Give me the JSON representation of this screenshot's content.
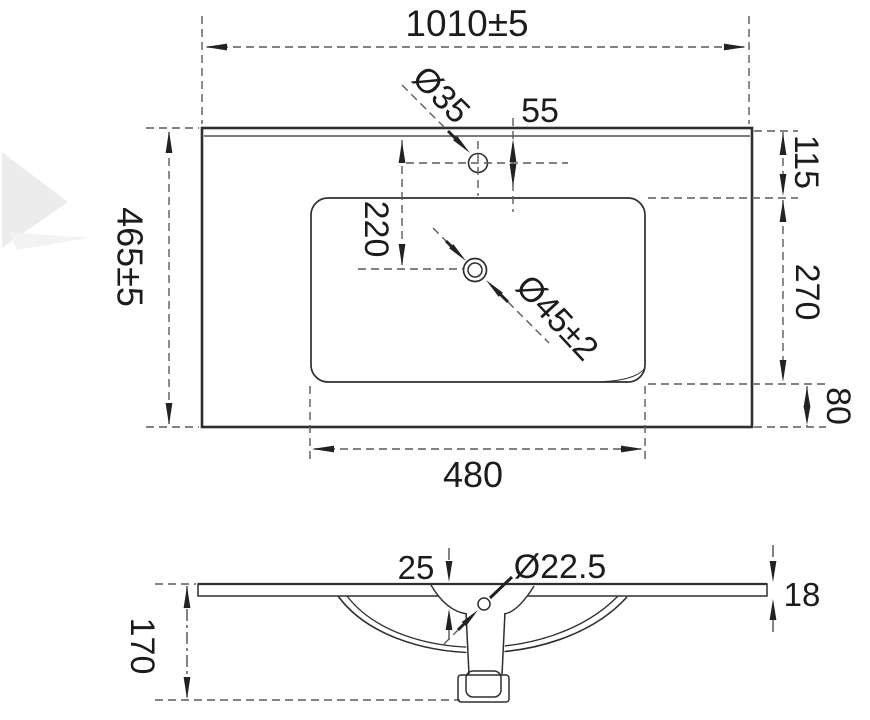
{
  "drawing_type": "ceramic basin technical drawing",
  "top_view": {
    "dimensions": {
      "overall_width": "1010±5",
      "overall_depth": "465±5",
      "faucet_hole_diameter": "Ø35",
      "faucet_hole_offset": "55",
      "rim_to_basin": "115",
      "basin_depth_span": "270",
      "basin_to_front_edge": "80",
      "drain_center_offset": "220",
      "basin_width": "480",
      "drain_diameter": "Ø45±2"
    }
  },
  "side_view": {
    "dimensions": {
      "overall_height": "170",
      "recess_depth": "25",
      "overflow_hole_diameter": "Ø22.5",
      "slab_thickness": "18"
    }
  },
  "colors": {
    "line": "#2f2f2f",
    "dim_line": "#5a5a5a",
    "text": "#1c1c1c",
    "watermark": "#ececec"
  }
}
